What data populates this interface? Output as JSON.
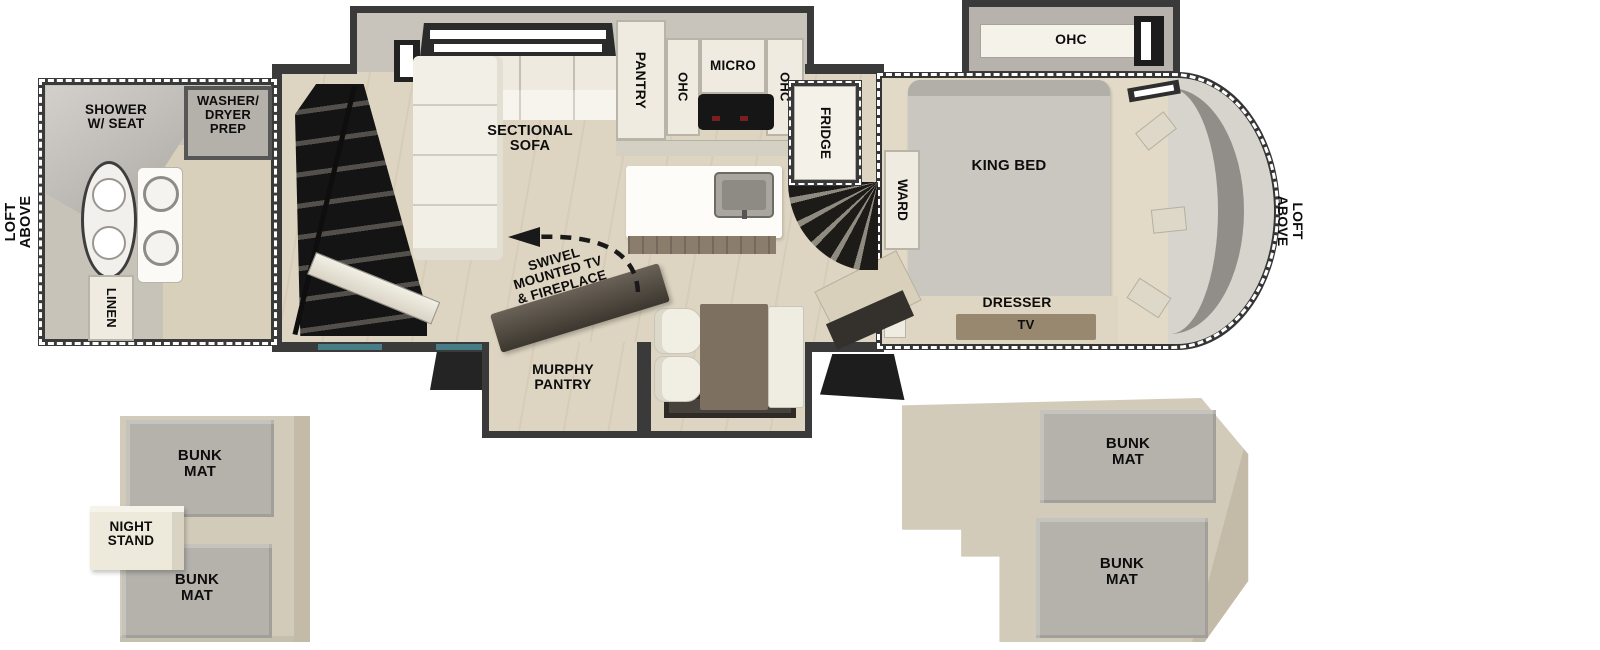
{
  "title": "RV fifth-wheel floor plan with loft diagrams",
  "fp": {
    "bath": {
      "loft_above": "LOFT\nABOVE",
      "shower": "SHOWER\nW/ SEAT",
      "washer": "WASHER/\nDRYER\nPREP",
      "linen": "LINEN"
    },
    "living": {
      "sofa": "SECTIONAL\nSOFA",
      "swivel": "SWIVEL\nMOUNTED TV\n& FIREPLACE",
      "murphy": "MURPHY\nPANTRY"
    },
    "kitchen": {
      "pantry": "PANTRY",
      "ohc_left": "OHC",
      "micro": "MICRO",
      "ohc_right": "OHC",
      "fridge": "FRIDGE"
    },
    "bedroom": {
      "ward": "WARD",
      "king": "KING BED",
      "ohc": "OHC",
      "dresser": "DRESSER",
      "tv": "TV",
      "loft_above": "LOFT\nABOVE"
    },
    "loft_left": {
      "bunk_top": "BUNK\nMAT",
      "night_stand": "NIGHT\nSTAND",
      "bunk_bottom": "BUNK\nMAT"
    },
    "loft_right": {
      "bunk_top": "BUNK\nMAT",
      "bunk_bottom": "BUNK\nMAT"
    }
  },
  "colors": {
    "wall": "#3a3a3a",
    "floor_wood": "#ddd4c1",
    "floor_bedroom": "#e2dac7",
    "furniture_cream": "#efebe0",
    "mat_gray": "#b5b2ac",
    "platform": "#d2cbb9",
    "table_brown": "#7d7060",
    "tv_brown": "#97886f",
    "stairs_black": "#1d1b18",
    "window_teal": "#477d86",
    "dash_white": "#ffffff",
    "label_black": "#0d0d0d"
  }
}
